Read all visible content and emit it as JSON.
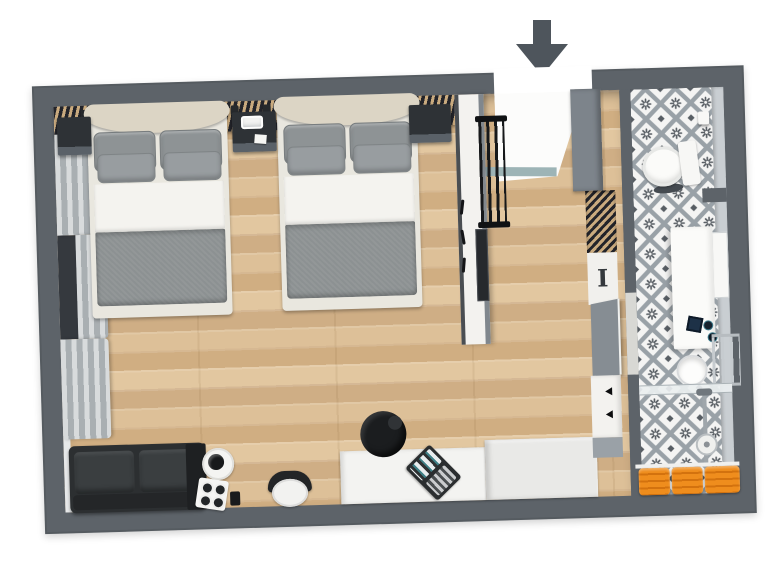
{
  "meta": {
    "type": "3d-floor-plan",
    "description": "Top-down 3D rendered floor plan of a hotel-style studio room with two double beds, lounge corner, desk, entry hall with closets and an en-suite bathroom",
    "entry_direction": "down"
  },
  "palette": {
    "bg": "#ffffff",
    "wall": "#5d6369",
    "wallface": "#c9ced2",
    "threshold": "#9db4b6",
    "slatdark": "#23242a",
    "slattan": "#c9aa7e",
    "headboard": "#dcd5c5",
    "pillow": "#8e9395",
    "sheet": "#f4f3ef",
    "duvet": "#8c9192",
    "bedbase": "#e9e7df",
    "sofa": "#2c2f31",
    "cabinet": "#7d848b",
    "glassdark": "#35393e",
    "orange": "#ef8d1d",
    "orangedark": "#d3720e",
    "tile_bg": "#f4f4f3",
    "tile_grid": "#99a1a7",
    "tile_motif": "#575d63",
    "wood_light": "#e2c7a0",
    "wood_dark": "#cfae85"
  },
  "labels": {
    "iron_panel_glyph": "I"
  },
  "rooms": [
    {
      "name": "bedroom",
      "floor": "wood planks"
    },
    {
      "name": "entry-hall",
      "floor": "wood planks"
    },
    {
      "name": "bathroom",
      "floor": "patterned gray-white tile"
    }
  ],
  "furniture": {
    "bedroom": [
      "slatted headboard feature wall",
      "double bed 1",
      "double bed 2",
      "center nightstand with phone and card",
      "left nightstand",
      "right nightstand",
      "4 wall reading lights",
      "window with gray curtains",
      "dark two-seat sofa",
      "side console with kettle tray, espresso cups and grinder",
      "tub chair",
      "desk with laptop",
      "office chair",
      "sideboard"
    ],
    "entry-hall": [
      "entry door swing",
      "door threshold",
      "partition wall with hooks",
      "luggage rack",
      "full-length mirror",
      "gray wardrobe cabinet",
      "slatted shelf",
      "ironing board panel",
      "open bathroom door",
      "closet doors with handles"
    ],
    "bathroom": [
      "wall-hung toilet",
      "toilet paper roll",
      "privacy wall stub",
      "vanity counter",
      "toiletry accessories",
      "round sink bowl",
      "towel ladder",
      "wall mirror",
      "glass shower partition",
      "shower column and head",
      "floor drain",
      "3 orange towels on shelf"
    ]
  },
  "annotations": {
    "entry_arrow": "dark gray arrow pointing down into entrance opening"
  }
}
